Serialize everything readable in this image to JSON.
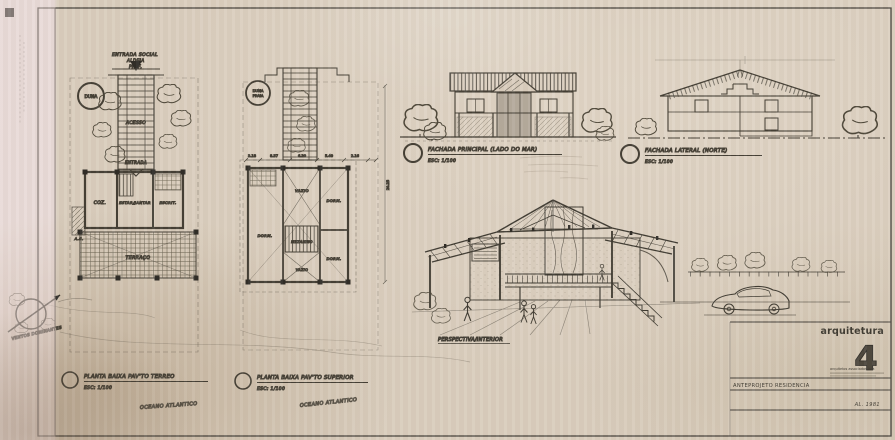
{
  "colors": {
    "ink": "#3e3a31",
    "paper": "#d9cdbd",
    "accent": "#2e2b26"
  },
  "ground_plan": {
    "entry_line1": "ENTRADA SOCIAL",
    "entry_line2": "ALDEIA",
    "entry_line3": "PREF.",
    "dune": "DUNA",
    "walkway": "ACESSO",
    "entrance": "ENTRADA",
    "room_kitchen": "COZ.",
    "room_service": "A.S.",
    "room_living": "ESTAR/JANTAR",
    "room_office": "ESCRIT.",
    "room_terrace": "TERRAÇO",
    "caption": "PLANTA BAIXA PAV'TO TERREO",
    "scale": "ESC: 1/100",
    "ocean": "OCEANO ATLANTICO"
  },
  "upper_plan": {
    "dune1": "DUNA",
    "dune2": "PRAIA",
    "room_bed_left": "DORM.",
    "room_bed_right_top": "DORM.",
    "room_bed_right_bottom": "DORM.",
    "mezzanine": "MEZANINO",
    "void_top": "VAZIO",
    "void_bottom": "VAZIO",
    "dims": [
      "3.18",
      "8.37",
      "6.20",
      "5.40",
      "2.16"
    ],
    "dim_right": "20.25",
    "caption": "PLANTA BAIXA PAV'TO SUPERIOR",
    "scale": "ESC: 1/100",
    "ocean": "OCEANO ATLANTICO"
  },
  "facade_main": {
    "caption": "FACHADA PRINCIPAL (LADO DO MAR)",
    "scale": "ESC: 1/100"
  },
  "facade_side": {
    "caption": "FACHADA LATERAL (NORTE)",
    "scale": "ESC: 1/100"
  },
  "perspective": {
    "caption": "PERSPECTIVA/INTERIOR"
  },
  "compass": {
    "label": "VENTOS DOMINANTES"
  },
  "title_block": {
    "brand": "arquitetura",
    "number": "4",
    "firm": "arquitetos associados ltda",
    "project": "ANTEPROJETO RESIDENCIA",
    "date": "AL. 1981"
  }
}
